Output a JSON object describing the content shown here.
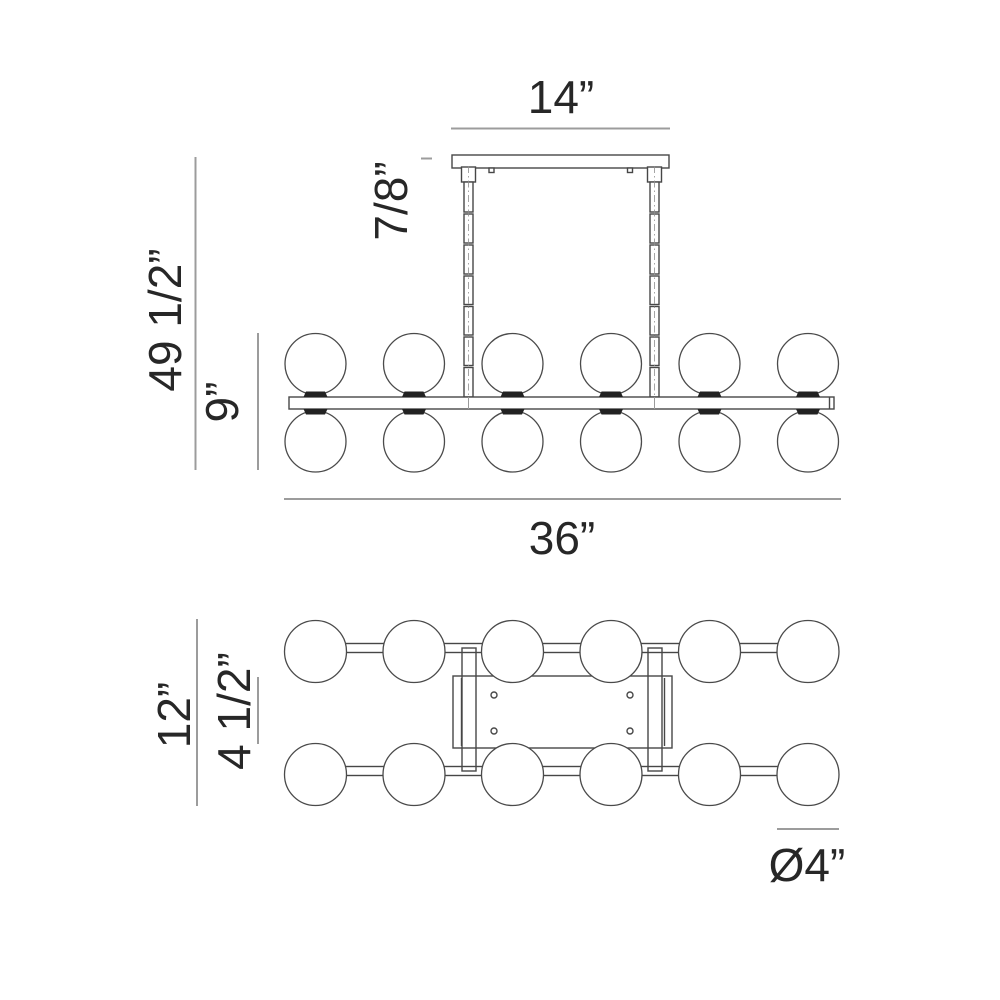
{
  "drawing": {
    "type": "lighting-fixture dimension drawing",
    "background_color": "#ffffff",
    "line_color": "#474747",
    "dimension_line_color": "#9c9c9c",
    "label_color": "#272727",
    "socket_color": "#222222"
  },
  "side_view": {
    "description": "front elevation of linear chandelier with canopy, two suspension rods, bar with globes",
    "globes_top_row": 6,
    "globes_bottom_row": 6,
    "suspension_rods": 2,
    "labels": {
      "canopy_width": "14”",
      "canopy_height": "7/8”",
      "overall_height": "49 1/2”",
      "fixture_height": "9”",
      "fixture_length": "36”"
    }
  },
  "top_view": {
    "description": "plan view of fixture with mounting plate and two rows of globes on rails",
    "globes_top_row": 6,
    "globes_bottom_row": 6,
    "screw_holes": 4,
    "labels": {
      "overall_width": "12”",
      "mounting_plate_width": "4 1/2”",
      "globe_diameter": "Ø4”"
    }
  }
}
